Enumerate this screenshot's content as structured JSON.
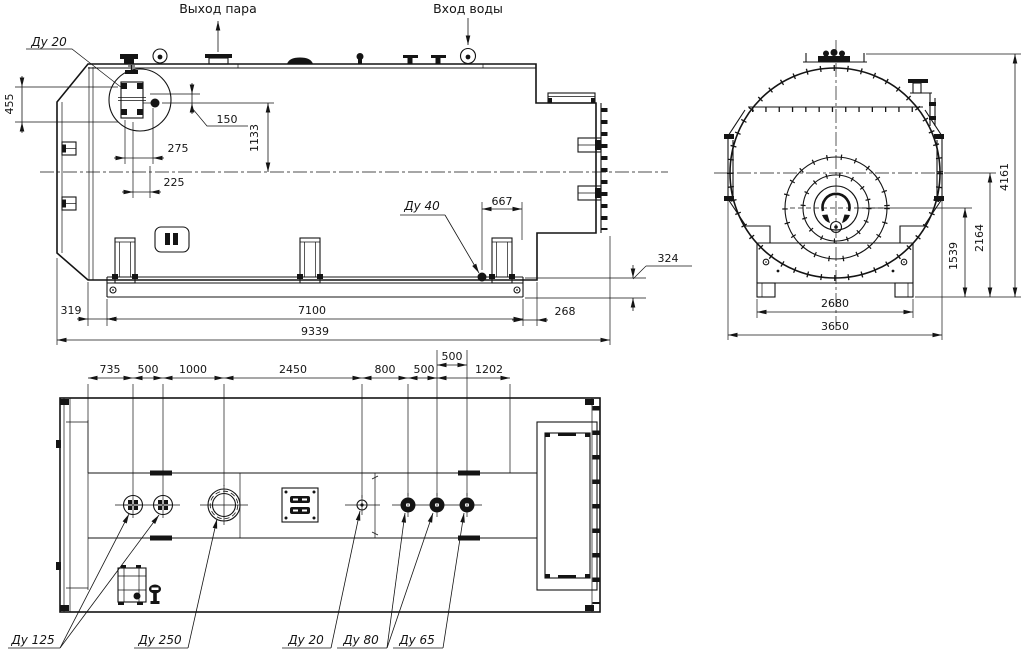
{
  "colors": {
    "ink": "#141414",
    "paper": "#ffffff"
  },
  "flow_annotations": {
    "steam_outlet": "Выход пара",
    "water_inlet": "Вход воды"
  },
  "nozzle_labels": {
    "dn20_detail": "Ду 20",
    "dn40_drain": "Ду 40",
    "dn125": "Ду 125",
    "dn250": "Ду 250",
    "dn20_bottom": "Ду 20",
    "dn80": "Ду 80",
    "dn65": "Ду 65"
  },
  "side_view": {
    "dim_455": "455",
    "dim_150": "150",
    "dim_1133": "1133",
    "dim_275": "275",
    "dim_225": "225",
    "dim_667": "667",
    "dim_324": "324",
    "dim_319": "319",
    "dim_7100": "7100",
    "dim_268": "268",
    "dim_9339": "9339"
  },
  "front_view": {
    "dim_4161": "4161",
    "dim_2164": "2164",
    "dim_1539": "1539",
    "dim_2680": "2680",
    "dim_3650": "3650"
  },
  "plan_view": {
    "chain": [
      "735",
      "500",
      "1000",
      "2450",
      "800",
      "500",
      "1202"
    ],
    "dim_500_offset": "500"
  }
}
